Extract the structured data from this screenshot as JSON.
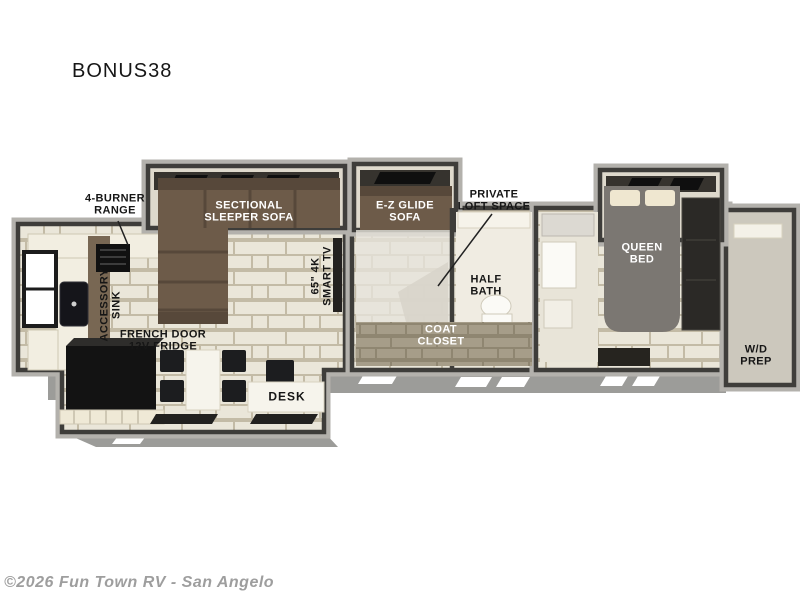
{
  "page": {
    "title": "BONUS38",
    "watermark": "©2026 Fun Town RV - San Angelo"
  },
  "floorplan": {
    "model": "BONUS38",
    "labels": {
      "burner_range": "4-BURNER\nRANGE",
      "accessory_sink": "ACCESSORY\nSINK",
      "sectional_sofa": "SECTIONAL\nSLEEPER SOFA",
      "smart_tv": "65\" 4K\nSMART TV",
      "ez_glide_sofa": "E-Z GLIDE\nSOFA",
      "private_loft": "PRIVATE\nLOFT SPACE",
      "half_bath": "HALF\nBATH",
      "coat_closet": "COAT\nCLOSET",
      "french_door_fridge": "FRENCH DOOR\n12V FRIDGE",
      "desk": "DESK",
      "queen_bed": "QUEEN\nBED",
      "wd_prep": "W/D\nPREP"
    },
    "colors": {
      "wall_dark": "#3e3d3a",
      "wall_light": "#b3b1ac",
      "floor_tile": "#eae6d9",
      "grout": "#c3bba6",
      "sofa_brown": "#6d5b49",
      "bed_gray": "#7b7772",
      "appliance_black": "#141414",
      "counter_cream": "#f2eee1",
      "skirt_gray": "#9c9c99",
      "closet_tan": "#a69d89",
      "label_dark": "#161616",
      "label_light": "#ffffff",
      "watermark_gray": "#9e9e9e"
    }
  }
}
